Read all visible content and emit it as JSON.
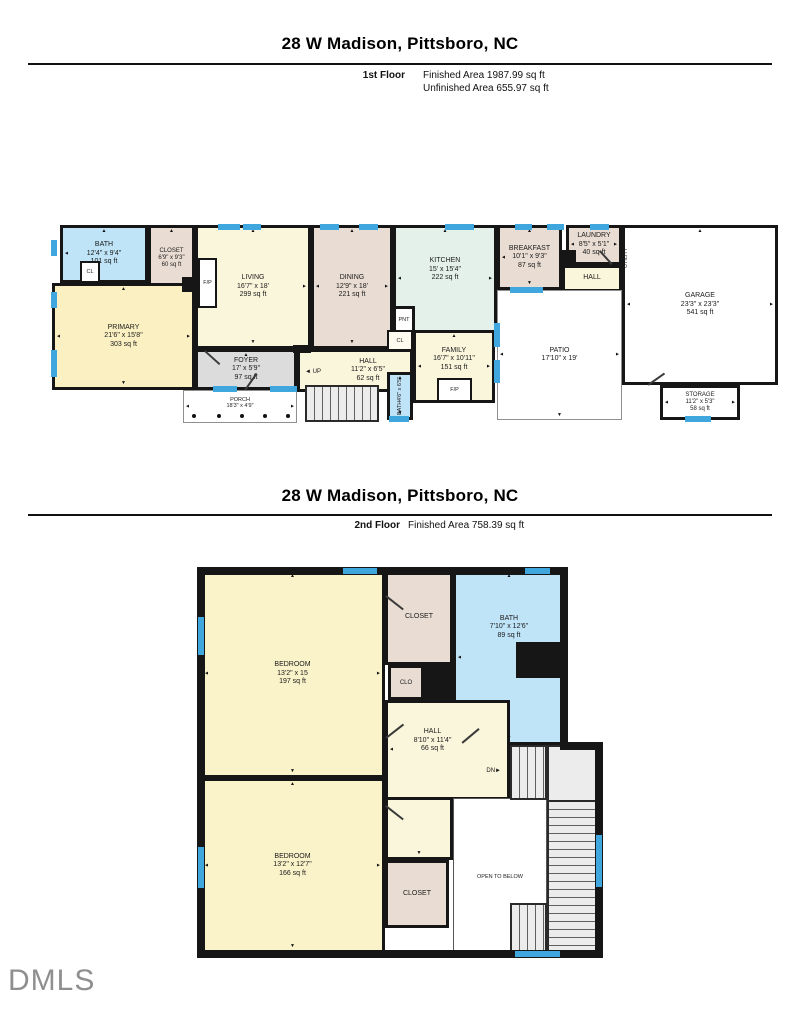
{
  "page1": {
    "title": "28 W Madison, Pittsboro, NC",
    "floor_label": "1st Floor",
    "area_lines": [
      "Finished Area 1987.99 sq ft",
      "Unfinished Area 655.97 sq ft"
    ]
  },
  "page2": {
    "title": "28 W Madison, Pittsboro, NC",
    "floor_label": "2nd Floor",
    "area_lines": [
      "Finished Area 758.39 sq ft"
    ]
  },
  "floor1": {
    "rooms": [
      {
        "name": "BATH",
        "dims": "12'4\" x 9'4\"",
        "area": "101 sq ft"
      },
      {
        "name": "CLOSET",
        "dims": "6'9\" x 9'3\"",
        "area": "60 sq ft"
      },
      {
        "name": "LIVING",
        "dims": "16'7\" x 18'",
        "area": "299 sq ft"
      },
      {
        "name": "DINING",
        "dims": "12'9\" x 18'",
        "area": "221 sq ft"
      },
      {
        "name": "KITCHEN",
        "dims": "15' x 15'4\"",
        "area": "222 sq ft"
      },
      {
        "name": "BREAKFAST",
        "dims": "10'1\" x 9'3\"",
        "area": "87 sq ft"
      },
      {
        "name": "LAUNDRY",
        "dims": "8'5\" x 5'1\"",
        "area": "40 sq ft"
      },
      {
        "name": "HALL"
      },
      {
        "name": "GARAGE",
        "dims": "23'3\" x 23'3\"",
        "area": "541 sq ft"
      },
      {
        "name": "PRIMARY",
        "dims": "21'6\" x 15'8\"",
        "area": "303 sq ft"
      },
      {
        "name": "FOYER",
        "dims": "17' x 5'9\"",
        "area": "97 sq ft"
      },
      {
        "name": "HALL",
        "dims": "11'2\" x 6'5\"",
        "area": "62 sq ft"
      },
      {
        "name": "FAMILY",
        "dims": "16'7\" x 10'11\"",
        "area": "151 sq ft"
      },
      {
        "name": "PATIO",
        "dims": "17'10\" x 19'"
      },
      {
        "name": "STORAGE",
        "dims": "11'2\" x 5'3\"",
        "area": "58 sq ft"
      },
      {
        "name": "PORCH",
        "dims": "18'3\" x 4'9\""
      },
      {
        "name": "BATH",
        "dims": "4'6\" x 6'5\""
      }
    ],
    "labels": {
      "cl": "CL",
      "fp": "F/P",
      "pnt": "PNT",
      "up": "UP",
      "utility": "UTILITY"
    }
  },
  "floor2": {
    "rooms": [
      {
        "name": "BEDROOM",
        "dims": "13'2\" x 15",
        "area": "197 sq ft"
      },
      {
        "name": "CLOSET"
      },
      {
        "name": "BATH",
        "dims": "7'10\" x 12'6\"",
        "area": "89 sq ft"
      },
      {
        "name": "CLO"
      },
      {
        "name": "HALL",
        "dims": "8'10\" x 11'4\"",
        "area": "66 sq ft"
      },
      {
        "name": "BEDROOM",
        "dims": "13'2\" x 12'7\"",
        "area": "166 sq ft"
      },
      {
        "name": "CLOSET"
      },
      {
        "name": "OPEN TO BELOW"
      }
    ],
    "labels": {
      "dn": "DN"
    }
  },
  "logo": "DMLS",
  "icons": {
    "arrow_up": "▲",
    "arrow_down": "▼",
    "arrow_left": "◄",
    "arrow_right": "►"
  }
}
